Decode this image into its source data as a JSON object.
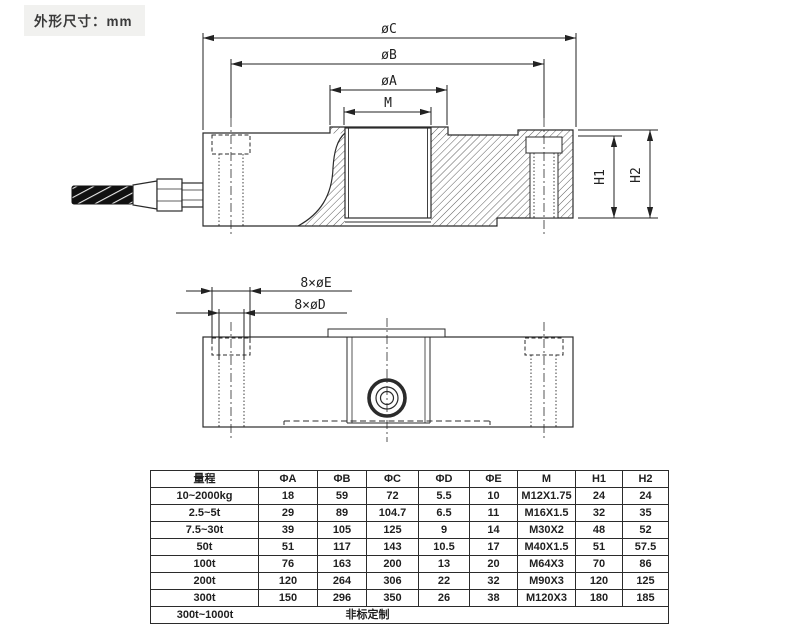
{
  "page": {
    "title": "外形尺寸：mm"
  },
  "colors": {
    "ink": "#2b2b2b",
    "title_bg": "#f1f1ef"
  },
  "drawing": {
    "dia_c": "øC",
    "dia_b": "øB",
    "dia_a": "øA",
    "thread_m": "M",
    "h1": "H1",
    "h2": "H2",
    "bolt_e": "8×øE",
    "bolt_d": "8×øD"
  },
  "table": {
    "headers": [
      "量程",
      "ΦA",
      "ΦB",
      "ΦC",
      "ΦD",
      "ΦE",
      "M",
      "H1",
      "H2"
    ],
    "rows": [
      [
        "10~2000kg",
        "18",
        "59",
        "72",
        "5.5",
        "10",
        "M12X1.75",
        "24",
        "24"
      ],
      [
        "2.5~5t",
        "29",
        "89",
        "104.7",
        "6.5",
        "11",
        "M16X1.5",
        "32",
        "35"
      ],
      [
        "7.5~30t",
        "39",
        "105",
        "125",
        "9",
        "14",
        "M30X2",
        "48",
        "52"
      ],
      [
        "50t",
        "51",
        "117",
        "143",
        "10.5",
        "17",
        "M40X1.5",
        "51",
        "57.5"
      ],
      [
        "100t",
        "76",
        "163",
        "200",
        "13",
        "20",
        "M64X3",
        "70",
        "86"
      ],
      [
        "200t",
        "120",
        "264",
        "306",
        "22",
        "32",
        "M90X3",
        "120",
        "125"
      ],
      [
        "300t",
        "150",
        "296",
        "350",
        "26",
        "38",
        "M120X3",
        "180",
        "185"
      ]
    ],
    "footer": {
      "range": "300t~1000t",
      "note": "非标定制"
    }
  }
}
